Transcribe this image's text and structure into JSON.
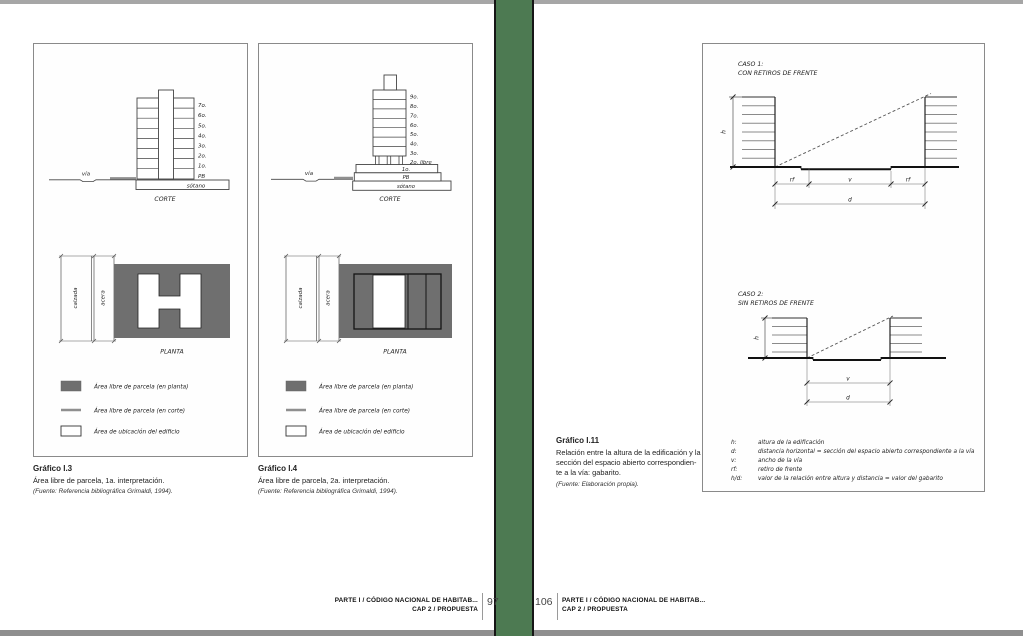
{
  "colors": {
    "gutter_green": "#4d7a52",
    "planta_gray": "#6f6f6f",
    "corte_line_gray": "#8f8f8f",
    "page_bg": "#ffffff"
  },
  "left_page": {
    "figure_a": {
      "corte": {
        "floors": [
          "7o.",
          "6o.",
          "5o.",
          "4o.",
          "3o.",
          "2o.",
          "1o.",
          "PB"
        ],
        "basement": "sótano",
        "street": "vía",
        "caption": "CORTE"
      },
      "planta": {
        "road": "calzada",
        "sidewalk": "acera",
        "caption": "PLANTA"
      },
      "legend": {
        "item1": "Área libre de parcela (en planta)",
        "item2": "Área libre de parcela (en corte)",
        "item3": "Área de ubicación del edificio"
      },
      "caption": {
        "title": "Gráfico I.3",
        "text": "Área libre de parcela, 1a. interpretación.",
        "source": "(Fuente: Referencia bibliográfica Grimaldi, 1994)."
      }
    },
    "figure_b": {
      "corte": {
        "floors": [
          "9o.",
          "8o.",
          "7o.",
          "6o.",
          "5o.",
          "4o.",
          "3o."
        ],
        "free_floor": "2o. libre",
        "first_floor": "1o.",
        "ground_floor": "PB",
        "basement": "sótano",
        "street": "vía",
        "caption": "CORTE"
      },
      "planta": {
        "road": "calzada",
        "sidewalk": "acera",
        "caption": "PLANTA"
      },
      "legend": {
        "item1": "Área libre de parcela (en planta)",
        "item2": "Área libre de parcela (en corte)",
        "item3": "Área de ubicación del edificio"
      },
      "caption": {
        "title": "Gráfico I.4",
        "text": "Área libre de parcela, 2a. interpretación.",
        "source": "(Fuente: Referencia bibliográfica Grimaldi, 1994)."
      }
    },
    "footer": {
      "line1": "PARTE I / CÓDIGO NACIONAL DE HABITAB...",
      "line2": "CAP 2 / PROPUESTA",
      "page": "97"
    }
  },
  "right_page": {
    "caso1": {
      "title1": "CASO 1:",
      "title2": "CON RETIROS DE FRENTE",
      "h": "h",
      "rf_left": "rf",
      "v": "v",
      "rf_right": "rf",
      "d": "d"
    },
    "caso2": {
      "title1": "CASO 2:",
      "title2": "SIN RETIROS DE FRENTE",
      "h": "h",
      "v": "v",
      "d": "d"
    },
    "legend": {
      "rows": [
        {
          "term": "h:",
          "def": "altura de la edificación"
        },
        {
          "term": "d:",
          "def": "distancia horizontal = sección del espacio abierto correspondiente a la vía"
        },
        {
          "term": "v:",
          "def": "ancho de la vía"
        },
        {
          "term": "rf:",
          "def": "retiro de frente"
        },
        {
          "term": "h/d:",
          "def": "valor de la relación entre altura y distancia = valor del gabarito"
        }
      ]
    },
    "caption": {
      "title": "Gráfico I.11",
      "text": "Relación entre la altura de la edificación y la\nsección del espacio abierto correspondien-\nte a la vía: gabarito.",
      "source": "(Fuente: Elaboración propia)."
    },
    "footer": {
      "page": "106",
      "line1": "PARTE I / CÓDIGO NACIONAL DE HABITAB...",
      "line2": "CAP 2 / PROPUESTA"
    }
  }
}
